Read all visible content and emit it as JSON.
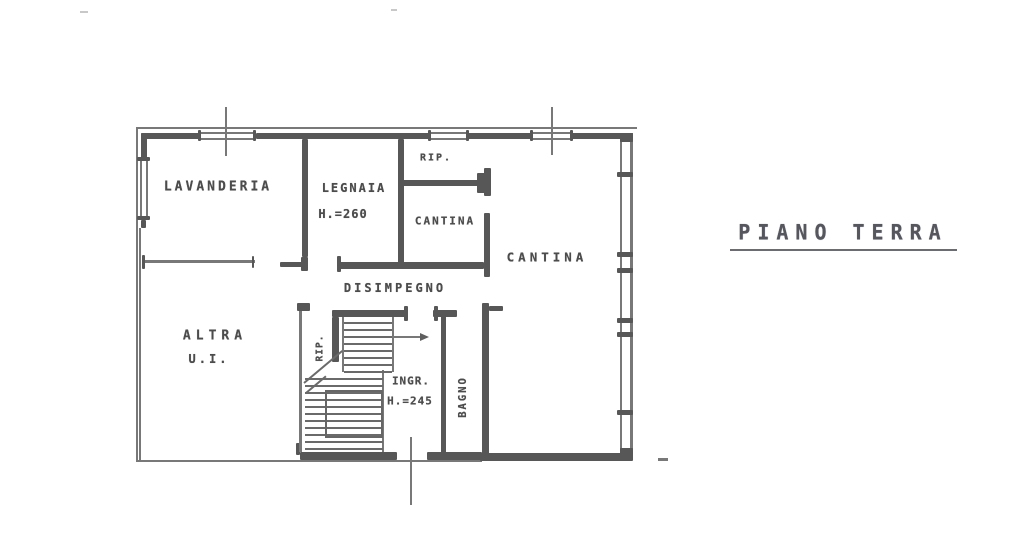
{
  "document": {
    "title": "PIANO TERRA"
  },
  "rooms": {
    "lavanderia": {
      "label": "LAVANDERIA"
    },
    "legnaia": {
      "label": "LEGNAIA",
      "height": "H.=260"
    },
    "rip_top": {
      "label": "RIP."
    },
    "cantina_small": {
      "label": "CANTINA"
    },
    "cantina_large": {
      "label": "CANTINA"
    },
    "disimpegno": {
      "label": "DISIMPEGNO"
    },
    "altra_ui": {
      "label": "ALTRA",
      "sublabel": "U.I."
    },
    "rip_understairs": {
      "label": "RIP."
    },
    "ingresso": {
      "label": "INGR.",
      "height": "H.=245"
    },
    "bagno": {
      "label": "BAGNO"
    }
  }
}
